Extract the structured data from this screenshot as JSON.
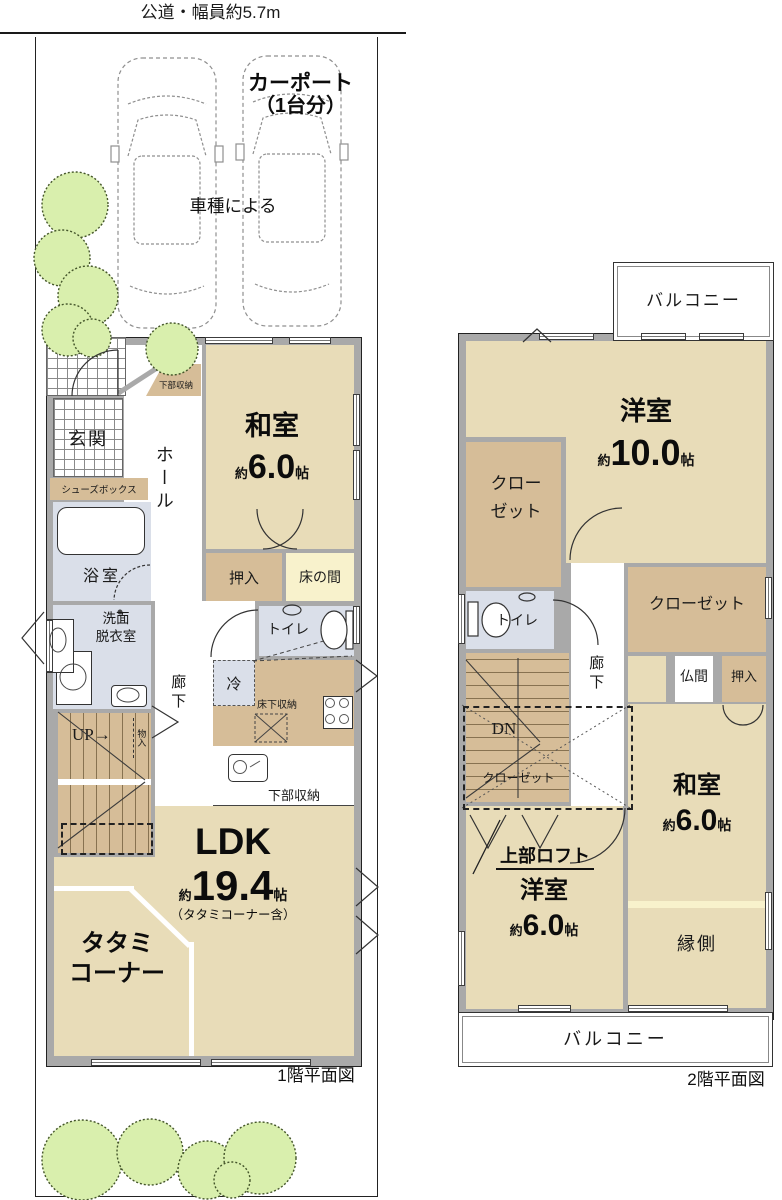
{
  "colors": {
    "room-beige": "#e8dcb8",
    "closet-tan": "#d6bd98",
    "water-blue": "#dadfe9",
    "tokonoma-yellow": "#f8f2cc",
    "wall-gray": "#a9a9a9",
    "greenery-fill": "#d9efad",
    "greenery-stroke": "#44552a",
    "line": "#2b2b2b"
  },
  "site": {
    "road_label": "公道・幅員約5.7m",
    "carport_title_line1": "カーポート",
    "carport_title_line2": "（1台分）",
    "carport_note": "車種による"
  },
  "floor1": {
    "caption": "1階平面図",
    "genkan": "玄関",
    "hall": "ホール",
    "kabu_shunou_top": "下部収納",
    "shoes_box": "シューズボックス",
    "washitsu": {
      "name": "和室",
      "approx": "約",
      "size": "6.0",
      "unit": "帖"
    },
    "oshiire": "押入",
    "tokonoma": "床の間",
    "bath": "浴室",
    "senmen_line1": "洗面",
    "senmen_line2": "脱衣室",
    "rouka": "廊下",
    "toilet": "トイレ",
    "rei": "冷",
    "yukashita_shunou": "床下収納",
    "kabu_shunou_kitchen": "下部収納",
    "up": "UP",
    "up_arrow": "→",
    "monoire": "物入",
    "ldk": {
      "name": "LDK",
      "approx": "約",
      "size": "19.4",
      "unit": "帖",
      "note": "（タタミコーナー含）"
    },
    "tatami_line1": "タタミ",
    "tatami_line2": "コーナー"
  },
  "floor2": {
    "caption": "2階平面図",
    "balcony_top": "バルコニー",
    "balcony_bottom": "バルコニー",
    "youshitsu10": {
      "name": "洋室",
      "approx": "約",
      "size": "10.0",
      "unit": "帖"
    },
    "closet1_line1": "クロー",
    "closet1_line2": "ゼット",
    "closet2": "クローゼット",
    "closet3": "クローゼット",
    "toilet": "トイレ",
    "rouka": "廊下",
    "butsuma": "仏間",
    "oshiire": "押入",
    "dn": "DN",
    "loft": "上部ロフト",
    "washitsu": {
      "name": "和室",
      "approx": "約",
      "size": "6.0",
      "unit": "帖"
    },
    "youshitsu6": {
      "name": "洋室",
      "approx": "約",
      "size": "6.0",
      "unit": "帖"
    },
    "engawa": "縁側"
  }
}
